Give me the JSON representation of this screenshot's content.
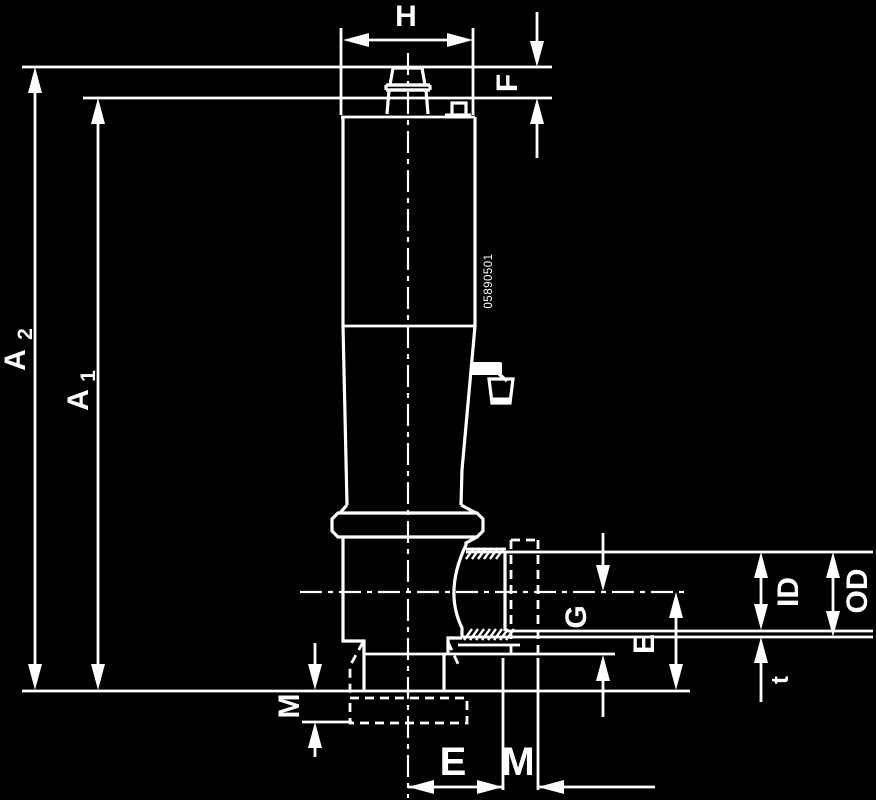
{
  "colors": {
    "background": "#000000",
    "ink": "#ffffff"
  },
  "drawing": {
    "type": "technical-dimension-drawing",
    "view": "side elevation of clamping pin with ball-end threaded port",
    "dimensions": {
      "H": "H",
      "F": "F",
      "A2_base": "A",
      "A2_sub": "2",
      "A1_base": "A",
      "A1_sub": "1",
      "G": "G",
      "E_right": "E",
      "ID": "ID",
      "OD": "OD",
      "t": "t",
      "M_left": "M",
      "E_bottom": "E",
      "M_bottom": "M"
    },
    "part_marking": "05890501"
  }
}
